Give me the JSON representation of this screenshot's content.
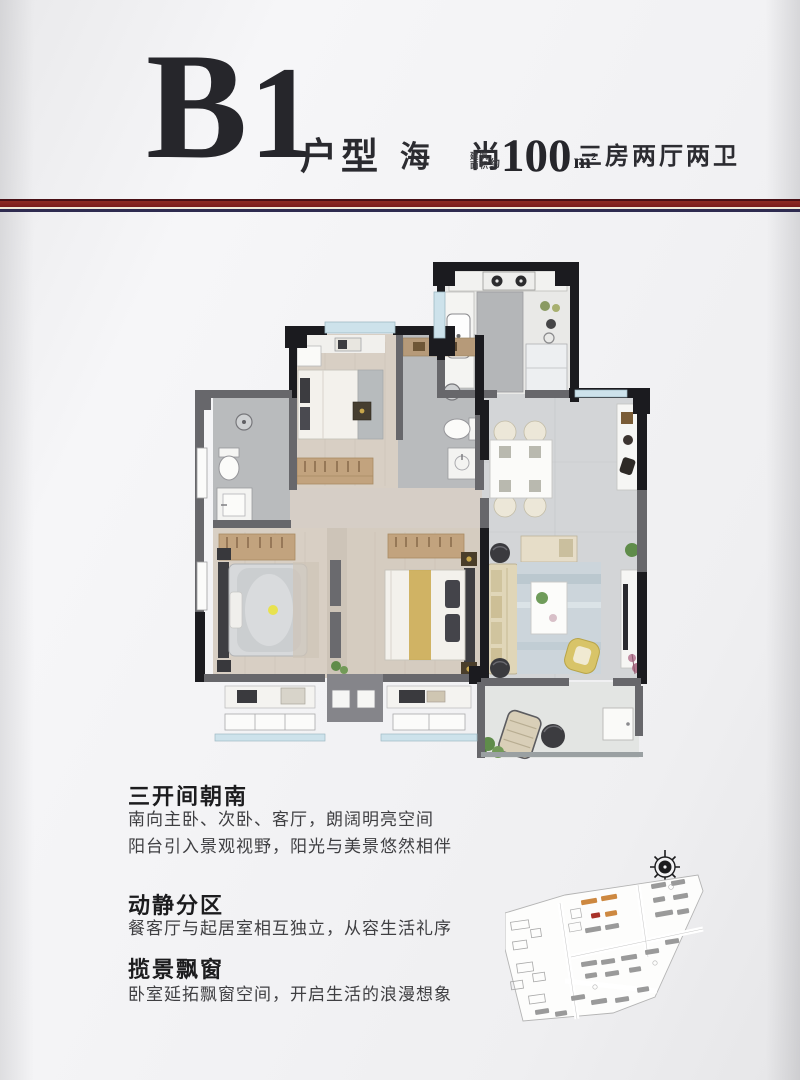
{
  "header": {
    "unit_code_letter": "B",
    "unit_code_digit": "1",
    "unit_label": "户型",
    "brand_name": "海 尚",
    "area_small_line1": "建筑",
    "area_small_line2": "面积",
    "area_approx": "约",
    "area_value": "100",
    "area_unit_m": "m",
    "area_unit_sup": "2",
    "spec": "三房两厅两卫"
  },
  "divider": {
    "accent_red": "#8e2a24",
    "accent_navy": "#2e2b50"
  },
  "floorplan": {
    "wall_color": "#1b1b1f",
    "wall_gray": "#67676b",
    "window_color": "#cde2eb",
    "wood_floor": "#d8cfc4",
    "tile_floor": "#d2d4d6",
    "bath_floor": "#b9bbbd",
    "accent_gold": "#c9a84c"
  },
  "sections": [
    {
      "heading": "三开间朝南",
      "lines": [
        "南向主卧、次卧、客厅，朗阔明亮空间",
        "阳台引入景观视野，阳光与美景悠然相伴"
      ]
    },
    {
      "heading": "动静分区",
      "lines": [
        "餐客厅与起居室相互独立，从容生活礼序"
      ]
    },
    {
      "heading": "揽景飘窗",
      "lines": [
        "卧室延拓飘窗空间，开启生活的浪漫想象"
      ]
    }
  ],
  "siteplan": {
    "building_color": "#8f8f8f",
    "highlight_color": "#cd8840",
    "marker_color": "#a83228"
  }
}
